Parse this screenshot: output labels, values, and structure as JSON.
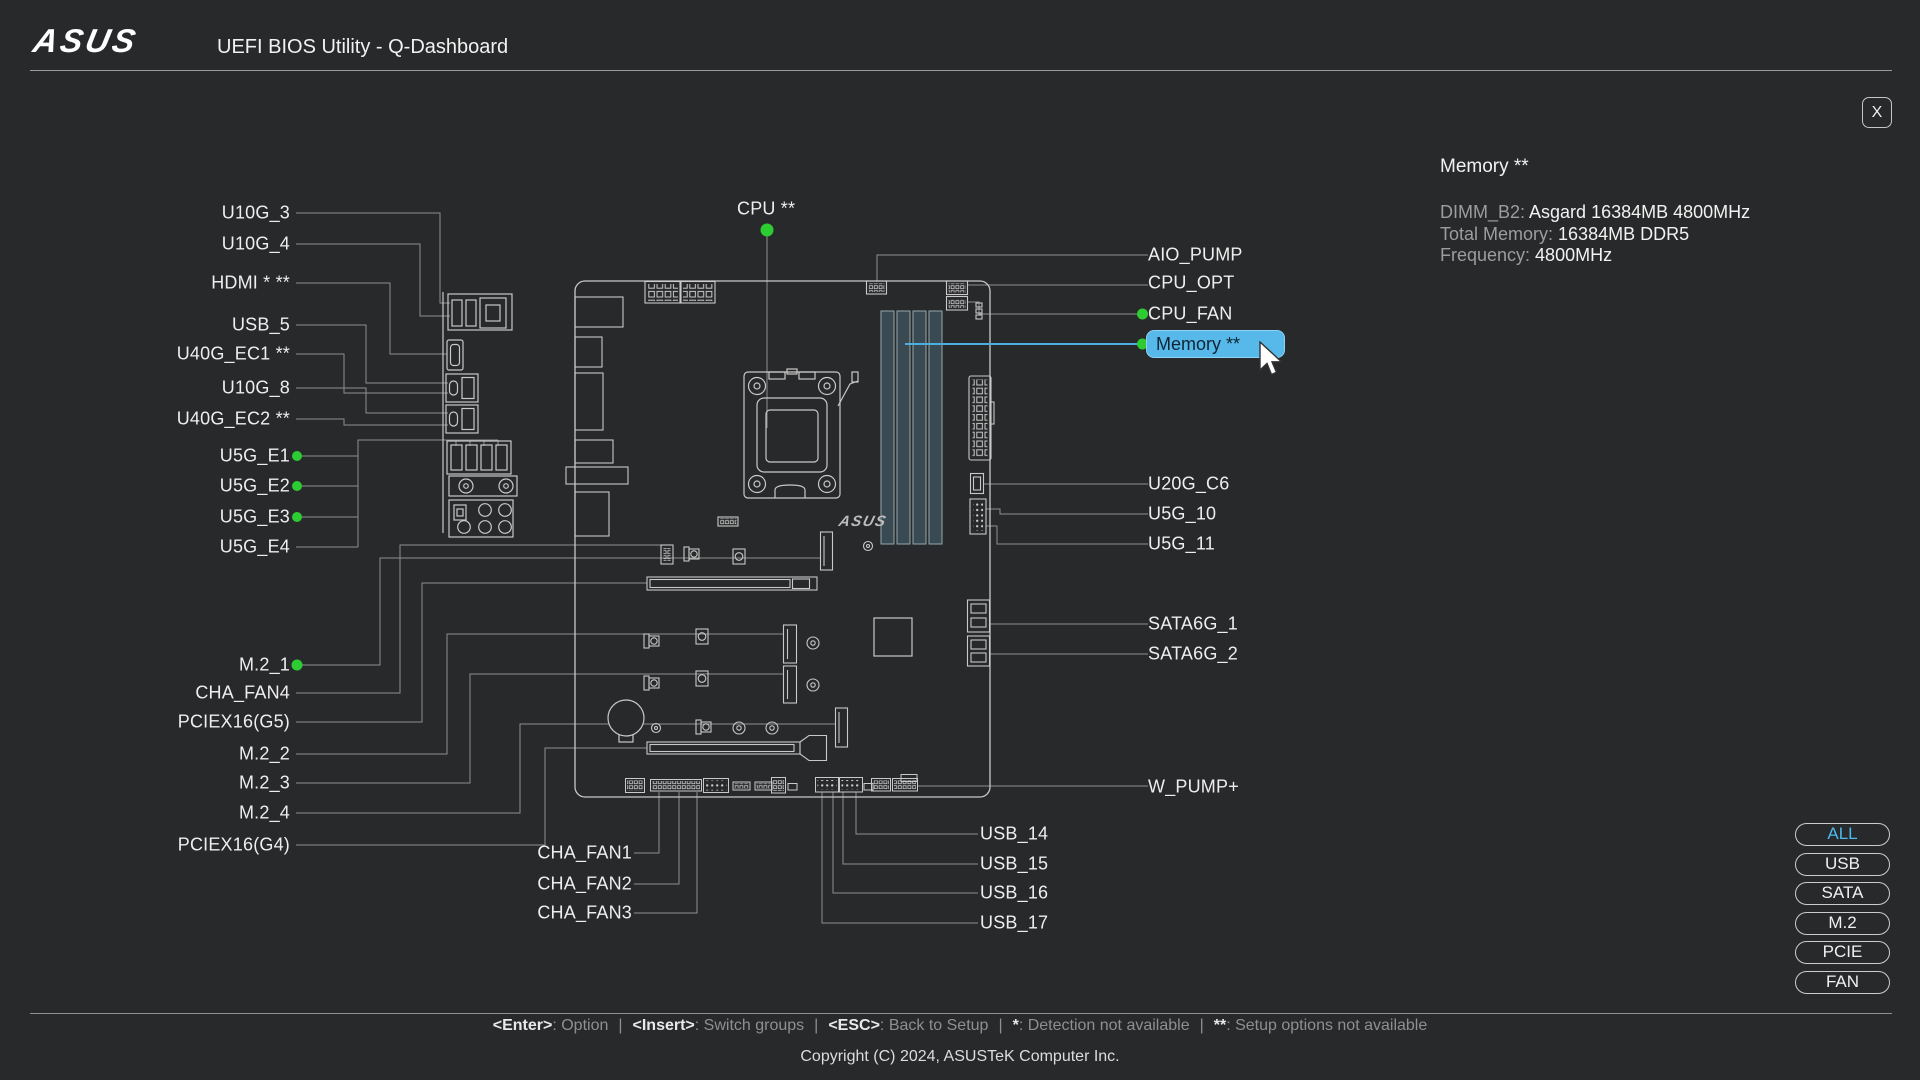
{
  "header": {
    "logo": "ASUS",
    "title": "UEFI BIOS Utility - Q-Dashboard",
    "close_label": "X"
  },
  "info_panel": {
    "title": "Memory **",
    "rows": [
      {
        "label": "DIMM_B2: ",
        "value": "Asgard 16384MB 4800MHz"
      },
      {
        "label": "Total Memory: ",
        "value": "16384MB DDR5"
      },
      {
        "label": "Frequency: ",
        "value": "4800MHz"
      }
    ]
  },
  "board": {
    "silkscreen_logo": "ASUS"
  },
  "selected_port": "memory",
  "port_labels": {
    "u10g_3": "U10G_3",
    "u10g_4": "U10G_4",
    "hdmi": "HDMI * **",
    "usb_5": "USB_5",
    "u40g_ec1": "U40G_EC1 **",
    "u10g_8": "U10G_8",
    "u40g_ec2": "U40G_EC2 **",
    "u5g_e1": "U5G_E1",
    "u5g_e2": "U5G_E2",
    "u5g_e3": "U5G_E3",
    "u5g_e4": "U5G_E4",
    "m2_1": "M.2_1",
    "cha_fan4": "CHA_FAN4",
    "pciex16_g5": "PCIEX16(G5)",
    "m2_2": "M.2_2",
    "m2_3": "M.2_3",
    "m2_4": "M.2_4",
    "pciex16_g4": "PCIEX16(G4)",
    "cpu": "CPU **",
    "aio_pump": "AIO_PUMP",
    "cpu_opt": "CPU_OPT",
    "cpu_fan": "CPU_FAN",
    "memory": "Memory **",
    "u20g_c6": "U20G_C6",
    "u5g_10": "U5G_10",
    "u5g_11": "U5G_11",
    "sata6g_1": "SATA6G_1",
    "sata6g_2": "SATA6G_2",
    "w_pump": "W_PUMP+",
    "cha_fan1": "CHA_FAN1",
    "cha_fan2": "CHA_FAN2",
    "cha_fan3": "CHA_FAN3",
    "usb_14": "USB_14",
    "usb_15": "USB_15",
    "usb_16": "USB_16",
    "usb_17": "USB_17"
  },
  "filters": {
    "items": [
      {
        "label": "ALL",
        "active": true
      },
      {
        "label": "USB",
        "active": false
      },
      {
        "label": "SATA",
        "active": false
      },
      {
        "label": "M.2",
        "active": false
      },
      {
        "label": "PCIE",
        "active": false
      },
      {
        "label": "FAN",
        "active": false
      }
    ]
  },
  "footer": {
    "separator": "|",
    "hints": [
      {
        "key": "<Enter>",
        "desc": ": Option"
      },
      {
        "key": "<Insert>",
        "desc": ": Switch groups"
      },
      {
        "key": "<ESC>",
        "desc": ": Back to Setup"
      },
      {
        "key": "*",
        "desc": ": Detection not available"
      },
      {
        "key": "**",
        "desc": ": Setup options not available"
      }
    ],
    "copyright": "Copyright (C) 2024, ASUSTeK Computer Inc."
  },
  "colors": {
    "accent_blue": "#4db9ef",
    "selection_fill": "#56b9ea",
    "detect_green": "#2ecc33",
    "line_gray": "#8e8e8e",
    "background": "#28292a"
  }
}
